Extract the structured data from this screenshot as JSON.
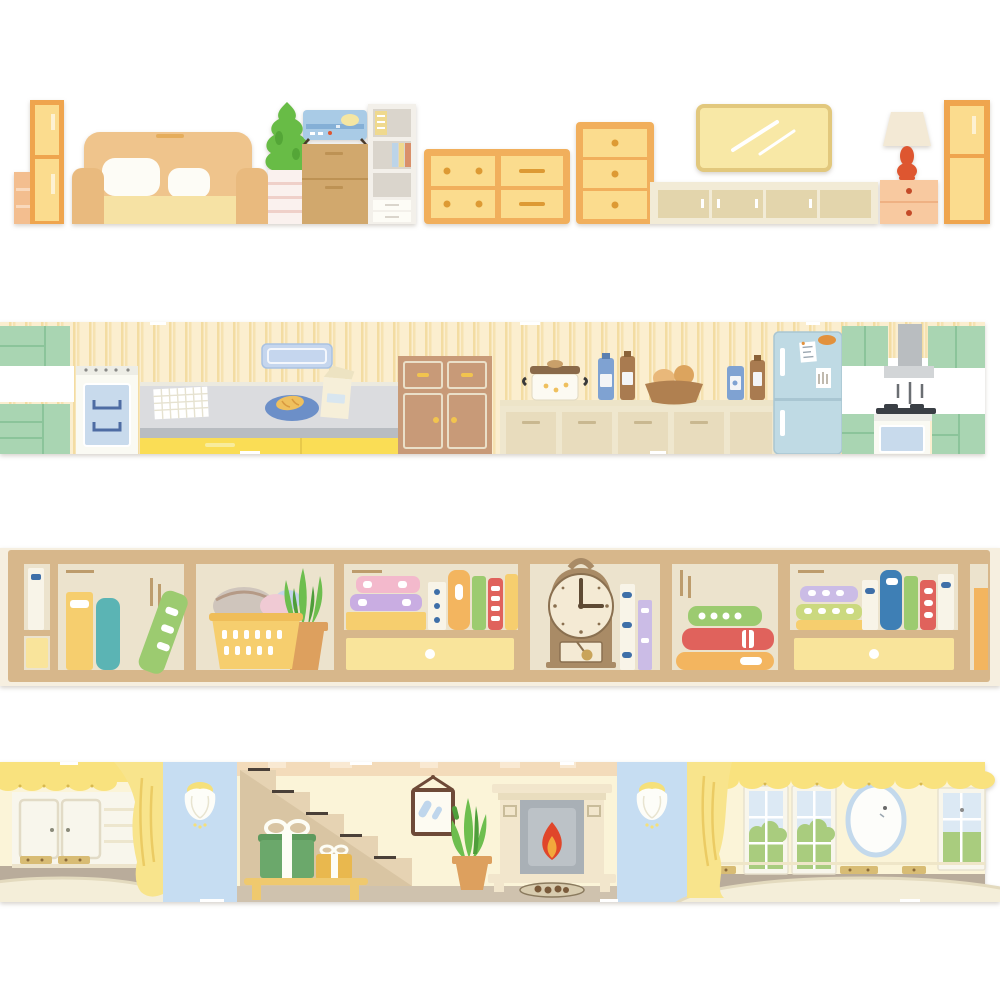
{
  "page": {
    "description": "Four illustrated washi-tape border strips depicting cozy home interiors on a white background"
  },
  "strips": [
    {
      "name": "living-room-furniture",
      "scene": "Living room furniture lineup: shelf, tall cabinets, sofa, potted tree, radio on drawer cabinet, bookcase, dressers, wall TV, TV stand, lamp on nightstand",
      "items": [
        "side-shelf",
        "tall-cabinet",
        "sofa",
        "potted-tree",
        "radio",
        "drawer-cabinet",
        "bookcase",
        "double-dresser",
        "tall-chest",
        "wall-tv",
        "tv-stand",
        "table-lamp",
        "nightstand",
        "tall-cabinet-right"
      ]
    },
    {
      "name": "kitchen",
      "scene": "Kitchen with striped wallpaper: green cabinets, stove, counter with cloth, plate of food, milk carton, hutch, pot, bottles, bread basket, refrigerator, range hood and cooktop",
      "items": [
        "green-upper-cabinet",
        "green-lower-cabinet",
        "stove-oven",
        "counter",
        "checkered-cloth",
        "plate-of-food",
        "milk-carton",
        "wall-board",
        "hutch-cabinet",
        "cooking-pot",
        "sauce-bottles",
        "bread-basket",
        "refrigerator",
        "range-hood",
        "cooktop-oven",
        "green-kitchen-cabinets"
      ]
    },
    {
      "name": "bookshelf",
      "scene": "Wooden bookshelf compartments with books, laundry basket with clothes, potted aloe, drawers and a pendulum clock",
      "clock_time": "3:00",
      "items": [
        "white-book",
        "standing-books",
        "leaning-book",
        "laundry-basket",
        "potted-aloe",
        "stacked-books",
        "book-row",
        "drawer",
        "pendulum-clock",
        "horizontal-book-stack",
        "book-collection",
        "drawer-right"
      ]
    },
    {
      "name": "parlor",
      "scene": "Parlor with yellow valances and curtains: white wardrobe, oval rugs, sconce wall panels, staircase with gifts on a bench, framed picture, potted plant, fireplace, windows and an oval mirror",
      "items": [
        "yellow-valance",
        "white-wardrobe",
        "oval-rug",
        "yellow-curtain",
        "sconce-panel",
        "staircase",
        "gift-boxes",
        "wood-bench",
        "framed-picture",
        "potted-plant",
        "fireplace",
        "sconce-panel-2",
        "windows",
        "oval-mirror",
        "oval-rug-right"
      ]
    }
  ],
  "palette": {
    "white": "#FFFFFF",
    "woodOrange": "#EFA54E",
    "panelYellow": "#FBDC8E",
    "dresserOrange": "#F1AF5C",
    "knobOrange": "#DD9A34",
    "sofaTan": "#EFC48C",
    "sofaSeat": "#F6E2A4",
    "sofaArm": "#E9BA7E",
    "cushionWhite": "#FDFCF6",
    "sideShelfPeach": "#F3BE8F",
    "sideShelfLine": "#F9D9BC",
    "treeGreen": "#68BC46",
    "treeGreenDark": "#54A637",
    "pedestalWhite": "#FAF1EE",
    "pedestalLine": "#EFD0C9",
    "radioBlue": "#A9CBE6",
    "radioBlueDark": "#84AFD6",
    "radioYellow": "#F4E6A3",
    "cabBrown": "#D1A86D",
    "cabBrownLine": "#BD9254",
    "shelfWhite": "#F3F0EA",
    "shelfGray": "#DAD5CC",
    "bookStripYellow": "#EFD98E",
    "bookStripBlue": "#BCD4E8",
    "bookStripRed": "#D9906A",
    "tvFill": "#F8E8A6",
    "tvEdge": "#E2C87D",
    "standCream": "#F2EBD6",
    "standDoor": "#E3D5AC",
    "nightPeach": "#F8C9A0",
    "nightLine": "#EFB183",
    "lampRed": "#DE5630",
    "lampShade": "#F3E9D5",
    "wallCream2": "#FBEECF",
    "wallStripe2": "#F3DCA2",
    "cabGreen": "#A9D5B2",
    "cabGreenLine": "#8BC49A",
    "stoveWhite": "#FAFAF3",
    "ovenBlue": "#C8DAEC",
    "ovenRack": "#4E6CA3",
    "counterGray": "#DBDCDF",
    "counterEdge": "#ECEADF",
    "counterDark": "#B8BCC1",
    "baseYellow": "#FADD55",
    "baseYellowLight": "#F8EC9C",
    "plateBlue": "#6C8FC8",
    "foodYellow": "#EFC05E",
    "foodBrown": "#D89A40",
    "cartonCream": "#F6EFD9",
    "cartonShade": "#EDE3C2",
    "boardBlue": "#C5D6EE",
    "boardBlueEdge": "#A9C2E2",
    "hutchBrown": "#C89A78",
    "hutchLine": "#EADFC8",
    "knobYellow": "#F2C44E",
    "cabCream": "#EFE7CE",
    "cabCreamDoor": "#E8DCBD",
    "cabCreamHandle": "#C9B890",
    "potWhite": "#FCFAF2",
    "lidBrown": "#8A6A4A",
    "lidTan": "#C9A06A",
    "bottleBlue": "#7FA2D2",
    "bottleBrown": "#A97B50",
    "labelLight": "#F3F4F6",
    "basketBrown2": "#B08050",
    "breadTan": "#E9B87A",
    "breadDark": "#DCA45E",
    "fridgeBlue": "#BFDAE4",
    "fridgeEdge": "#A9C6D2",
    "magnetOrange": "#E2913C",
    "hoodGray": "#B9BDC0",
    "hoodLight": "#D2D5D7",
    "hoodLine": "#6A6E72",
    "burnerDark": "#3A3F45",
    "counterWhite": "#EDEDE8",
    "edgeCream3": "#F6EFE0",
    "shelfTan": "#D7B78B",
    "shelfTanDark": "#BD9C6C",
    "compBg": "#ECE3CD",
    "drawerYellow": "#F9E49B",
    "bkYellow": "#F6CE6E",
    "bkTeal": "#5BB4B4",
    "bkGreen": "#9CCB70",
    "bkPink": "#F3B9CC",
    "bkPurple": "#C9ADE2",
    "bkOrange": "#F3B55F",
    "bkRed": "#E0625C",
    "bkBlue": "#3E7FB5",
    "bkWhite": "#F8F4E8",
    "bkLavender": "#CBBCE6",
    "bkLime": "#CBD97F",
    "bkMarkBlue": "#3E6FA8",
    "basketYellow": "#F6CE6E",
    "basketRim": "#EFBD59",
    "clothGray": "#CFC5BC",
    "clothPink": "#F0CAD4",
    "clothBlue": "#C5D5EA",
    "plantGreen": "#6DBE4E",
    "plantGreenDark": "#4E9E3A",
    "potTerra": "#DDA05E",
    "clockBrown": "#A98B66",
    "clockFace": "#F4EAD4",
    "clockDark": "#5E4A34",
    "clockRing": "#8A7050",
    "pendGold": "#C9A45A",
    "wallCream4": "#FBF4D8",
    "topBand": "#F3DBBA",
    "topBandLight": "#F9E9D2",
    "valanceYellow": "#F9E27E",
    "valanceDot": "#D8B84E",
    "curtainYellow": "#F8E48C",
    "curtainFold": "#EBCB63",
    "panelBlue": "#C6DDF2",
    "sconceWhite": "#FDFDF8",
    "sconceYellow": "#F5E07A",
    "wardrobeWhite": "#F8F6EC",
    "wardrobeLine": "#E2DBC6",
    "goldTrim": "#D8BC74",
    "goldDot": "#8A6A3A",
    "floorTaupe": "#B9AC9B",
    "midFloor": "#CFC2AE",
    "rugCream": "#F4EED9",
    "rugEdge": "#E3DABE",
    "stairBeige": "#E6D3B3",
    "stairUnder": "#D9C5A3",
    "stairDark": "#4A4038",
    "benchWood": "#EFC96E",
    "giftGreen": "#6BA86B",
    "giftGreenDark": "#5E9A5E",
    "ribbonWhite": "#FDFDF5",
    "giftYellow": "#E9B84E",
    "frameBrown": "#6E4A38",
    "glassBlue": "#BFD6EC",
    "fireCream": "#F2E6CC",
    "fireCreamDark": "#E9DDBE",
    "fireGray": "#A9B0B6",
    "fireGrayLight": "#BCC2C7",
    "flameRed": "#E0462A",
    "flameOrange": "#F2A83C",
    "logBrown": "#7A5A3A",
    "logTray": "#D8CCAF",
    "windowPane": "#DCE9F4",
    "foliageGreen": "#A9CC7E",
    "mirrorBlue": "#C3D9EC"
  }
}
